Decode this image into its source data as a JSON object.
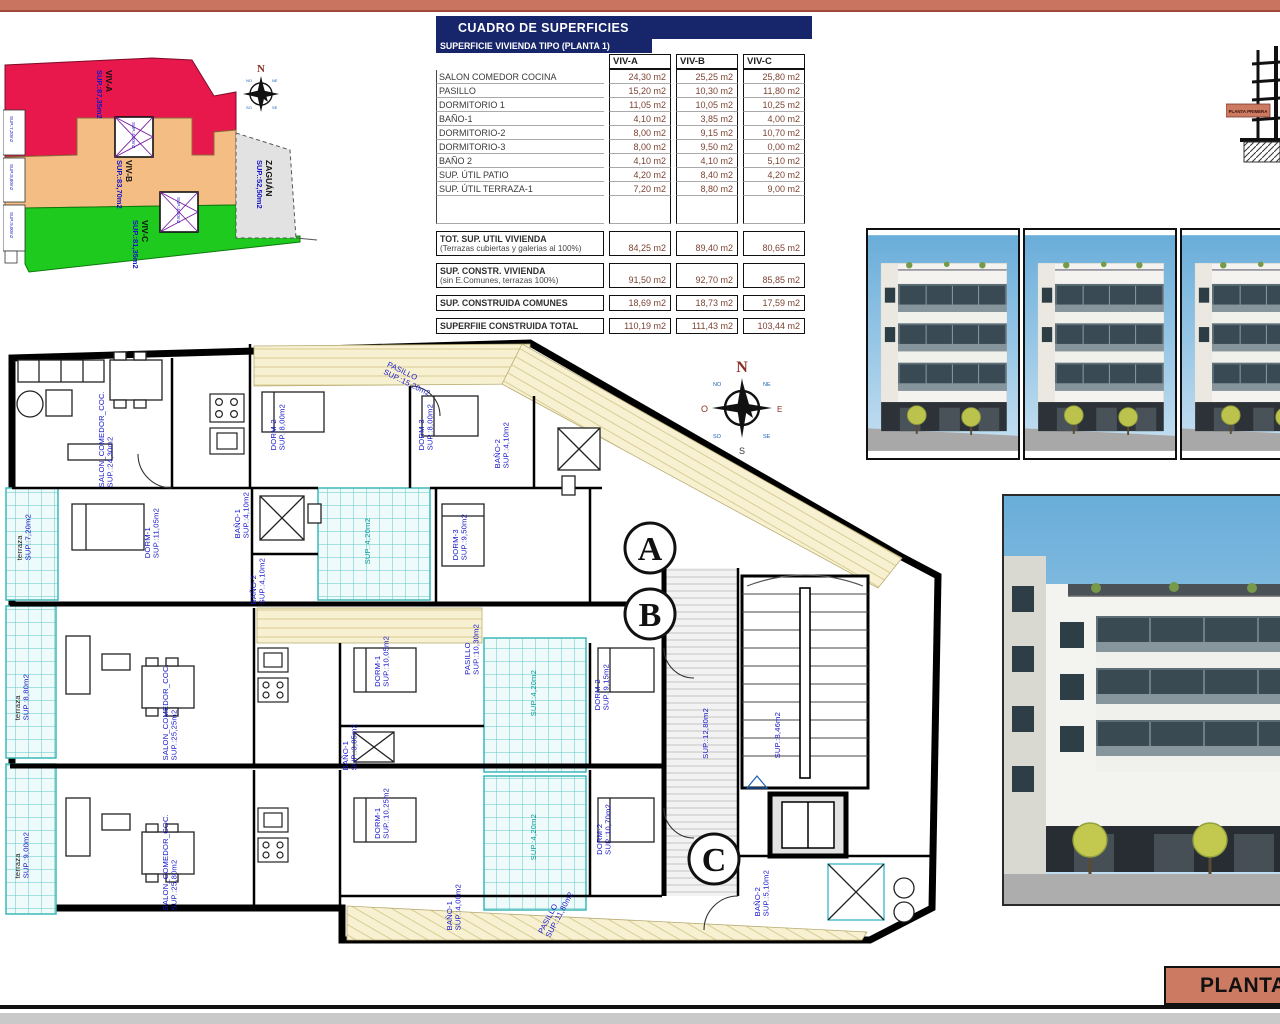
{
  "colors": {
    "band_salmon": "#c97361",
    "title_navy": "#17256b",
    "label_blue": "#1414c8",
    "plot_red": "#e9184c",
    "plot_tan": "#f4bd84",
    "plot_green": "#1fca1f",
    "plot_gray": "#e2e2e2",
    "patio_teal": "#3db8b8",
    "value_brown": "#7c4434"
  },
  "title_block": {
    "label": "PLANTA"
  },
  "elevation": {
    "tag": "PLANTA PRIMERA"
  },
  "compass": {
    "n": "N",
    "s": "S",
    "e": "E",
    "o": "O",
    "ne": "NE",
    "no": "NO",
    "se": "SE",
    "so": "SO"
  },
  "site_plan": {
    "plots": [
      {
        "name": "VIV-A",
        "sup": "SUP.:87,35m2"
      },
      {
        "name": "VIV-B",
        "sup": "SUP.:83,70m2"
      },
      {
        "name": "VIV-C",
        "sup": "SUP.:81,35m2"
      },
      {
        "name": "ZAGUÁN",
        "sup": "SUP.:52,50m2"
      }
    ],
    "edge_labels": [
      "SUP.:7,20m2",
      "SUP.:8,80m2",
      "SUP.:9,00m2"
    ],
    "patio_labels": [
      "SUP.:4,20m2",
      "SUP.:4,20m2"
    ]
  },
  "surfaces_table": {
    "title": "CUADRO DE SUPERFICIES",
    "subtitle": "SUPERFICIE VIVIENDA TIPO  (PLANTA 1)",
    "columns": [
      "VIV-A",
      "VIV-B",
      "VIV-C"
    ],
    "rows": [
      {
        "label": "SALON COMEDOR COCINA",
        "a": "24,30 m2",
        "b": "25,25 m2",
        "c": "25,80 m2"
      },
      {
        "label": "PASILLO",
        "a": "15,20 m2",
        "b": "10,30 m2",
        "c": "11,80 m2"
      },
      {
        "label": "DORMITORIO 1",
        "a": "11,05 m2",
        "b": "10,05 m2",
        "c": "10,25 m2"
      },
      {
        "label": "BAÑO-1",
        "a": "4,10 m2",
        "b": "3,85 m2",
        "c": "4,00 m2"
      },
      {
        "label": "DORMITORIO-2",
        "a": "8,00 m2",
        "b": "9,15 m2",
        "c": "10,70 m2"
      },
      {
        "label": "DORMITORIO-3",
        "a": "8,00 m2",
        "b": "9,50 m2",
        "c": "0,00 m2"
      },
      {
        "label": "BAÑO 2",
        "a": "4,10 m2",
        "b": "4,10 m2",
        "c": "5,10 m2"
      },
      {
        "label": "SUP. ÚTIL PATIO",
        "a": "4,20 m2",
        "b": "8,40 m2",
        "c": "4,20 m2"
      },
      {
        "label": "SUP. ÚTIL TERRAZA-1",
        "a": "7,20 m2",
        "b": "8,80 m2",
        "c": "9,00 m2"
      }
    ],
    "summary": [
      {
        "label": "TOT. SUP. UTIL VIVIENDA",
        "sub": "(Terrazas cubiertas y galerias al 100%)",
        "a": "84,25 m2",
        "b": "89,40 m2",
        "c": "80,65 m2"
      },
      {
        "label": "SUP. CONSTR. VIVIENDA",
        "sub": "(sin E.Comunes, terrazas 100%)",
        "a": "91,50 m2",
        "b": "92,70 m2",
        "c": "85,85 m2"
      },
      {
        "label": "SUP. CONSTRUIDA COMUNES",
        "sub": "",
        "a": "18,69 m2",
        "b": "18,73 m2",
        "c": "17,59 m2"
      },
      {
        "label": "SUPERFIIE CONSTRUIDA TOTAL",
        "sub": "",
        "a": "110,19 m2",
        "b": "111,43 m2",
        "c": "103,44 m2"
      }
    ]
  },
  "floor_plan": {
    "sections": [
      "A",
      "B",
      "C"
    ],
    "labels": [
      {
        "n": "SALON_COMEDOR_COC.",
        "s": "SUP.:24,30m2"
      },
      {
        "n": "PASILLO",
        "s": "SUP.:15,20m2"
      },
      {
        "n": "DORM-2",
        "s": "SUP.:8,00m2"
      },
      {
        "n": "DORM-3",
        "s": "SUP.:8,00m2"
      },
      {
        "n": "BAÑO-2",
        "s": "SUP.:4,10m2"
      },
      {
        "n": "terraza",
        "s": "SUP.:7,20m2"
      },
      {
        "n": "DORM-1",
        "s": "SUP.:11,05m2"
      },
      {
        "n": "BAÑO-1",
        "s": "SUP.:4,10m2"
      },
      {
        "n": "",
        "s": "SUP.:4,20m2"
      },
      {
        "n": "DORM-3",
        "s": "SUP.:9,50m2"
      },
      {
        "n": "PASILLO",
        "s": "SUP.:10,30m2"
      },
      {
        "n": "SALON_COMEDOR_COC.",
        "s": "SUP.:25,25m2"
      },
      {
        "n": "terraza",
        "s": "SUP.:8,80m2"
      },
      {
        "n": "DORM-1",
        "s": "SUP.:10,05m2"
      },
      {
        "n": "DORM-2",
        "s": "SUP.:9,15m2"
      },
      {
        "n": "BAÑO-1",
        "s": "SUP.:3,85m2"
      },
      {
        "n": "",
        "s": "SUP.:4,20m2"
      },
      {
        "n": "",
        "s": "SUP.:4,20m2"
      },
      {
        "n": "SALON_COMEDOR_COC.",
        "s": "SUP.:25,80m2"
      },
      {
        "n": "terraza",
        "s": "SUP.:9,00m2"
      },
      {
        "n": "DORM-1",
        "s": "SUP.:10,25m2"
      },
      {
        "n": "DORM-2",
        "s": "SUP.:10,70m2"
      },
      {
        "n": "BAÑO-1",
        "s": "SUP.:4,00m2"
      },
      {
        "n": "BAÑO-2",
        "s": "SUP.:5,10m2"
      },
      {
        "n": "",
        "s": "SUP.:12,80m2"
      },
      {
        "n": "",
        "s": "SUP.:8,46m2"
      },
      {
        "n": "PASILLO",
        "s": "SUP.:11,80m2"
      },
      {
        "n": "BAÑO-2",
        "s": "SUP.:4,10m2"
      }
    ]
  }
}
